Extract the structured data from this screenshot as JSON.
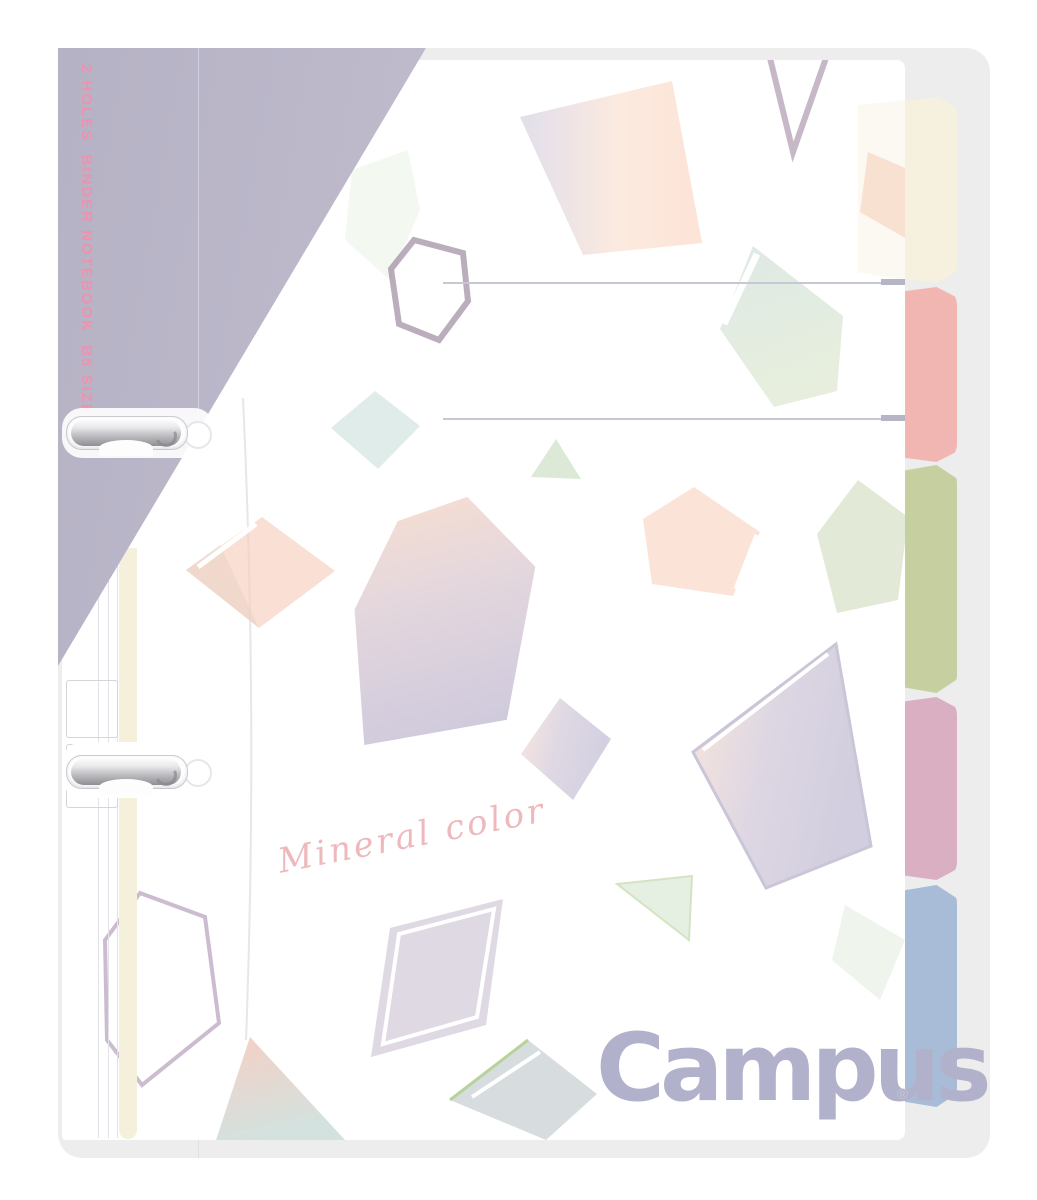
{
  "product": {
    "spine_text": "2 HOLES  BINDER NOTEBOOK  B5 SIZE",
    "script_text": "Mineral color",
    "brand": "Campus",
    "registered_mark": "®"
  },
  "tabs": [
    {
      "name": "cream",
      "color": "#f6f1de"
    },
    {
      "name": "salmon",
      "color": "#f2b6b2"
    },
    {
      "name": "green",
      "color": "#c5cfa0"
    },
    {
      "name": "mauve",
      "color": "#d9afc1"
    },
    {
      "name": "blue",
      "color": "#a8bcd7"
    }
  ],
  "colors": {
    "back_cover": "#ecedec",
    "front_cover": "#ffffff",
    "wrap_band": "#b9b5c8",
    "spine_text": "#ee92ae",
    "logo": "#b2b1cb",
    "script": "#eeb9bd",
    "title_line": "#c8c7d6",
    "metal_clip": "#bcbcc0"
  }
}
